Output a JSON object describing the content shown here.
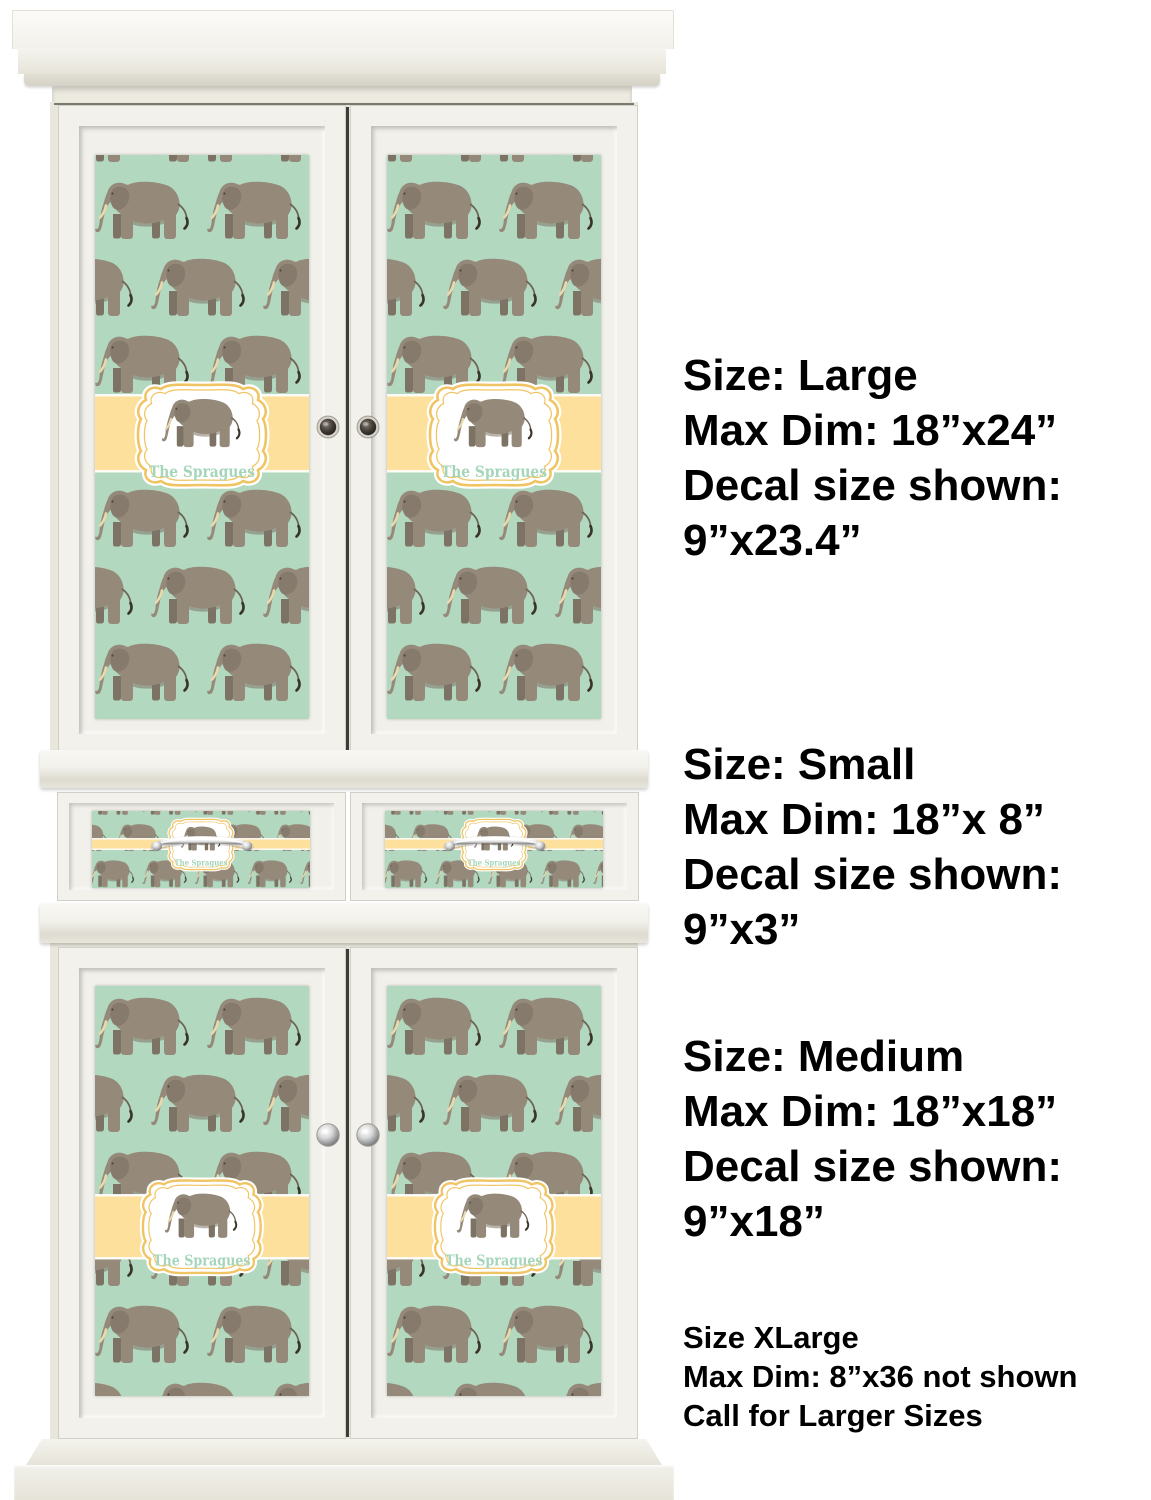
{
  "decal": {
    "family_name": "The Spragues",
    "design": "elephant-pattern",
    "colors": {
      "background_mint": "#b2d8c0",
      "band_yellow": "#fcE09c",
      "frame_gold": "#f0c463",
      "name_text": "#a5d6ba",
      "elephant_body": "#95897a",
      "elephant_dark": "#7d7365",
      "tusk": "#e9d9ab"
    }
  },
  "size_annotations": [
    {
      "lines": [
        "Size: Large",
        "Max Dim: 18”x24”",
        "Decal size shown:",
        "9”x23.4”"
      ]
    },
    {
      "lines": [
        "Size: Small",
        "Max Dim: 18”x 8”",
        "Decal size shown:",
        "9”x3”"
      ]
    },
    {
      "lines": [
        "Size: Medium",
        "Max Dim: 18”x18”",
        "Decal size shown:",
        "9”x18”"
      ]
    },
    {
      "lines": [
        "Size XLarge",
        "Max Dim: 8”x36 not shown",
        "Call for Larger Sizes"
      ]
    }
  ],
  "annotation_text_color": "#000000"
}
